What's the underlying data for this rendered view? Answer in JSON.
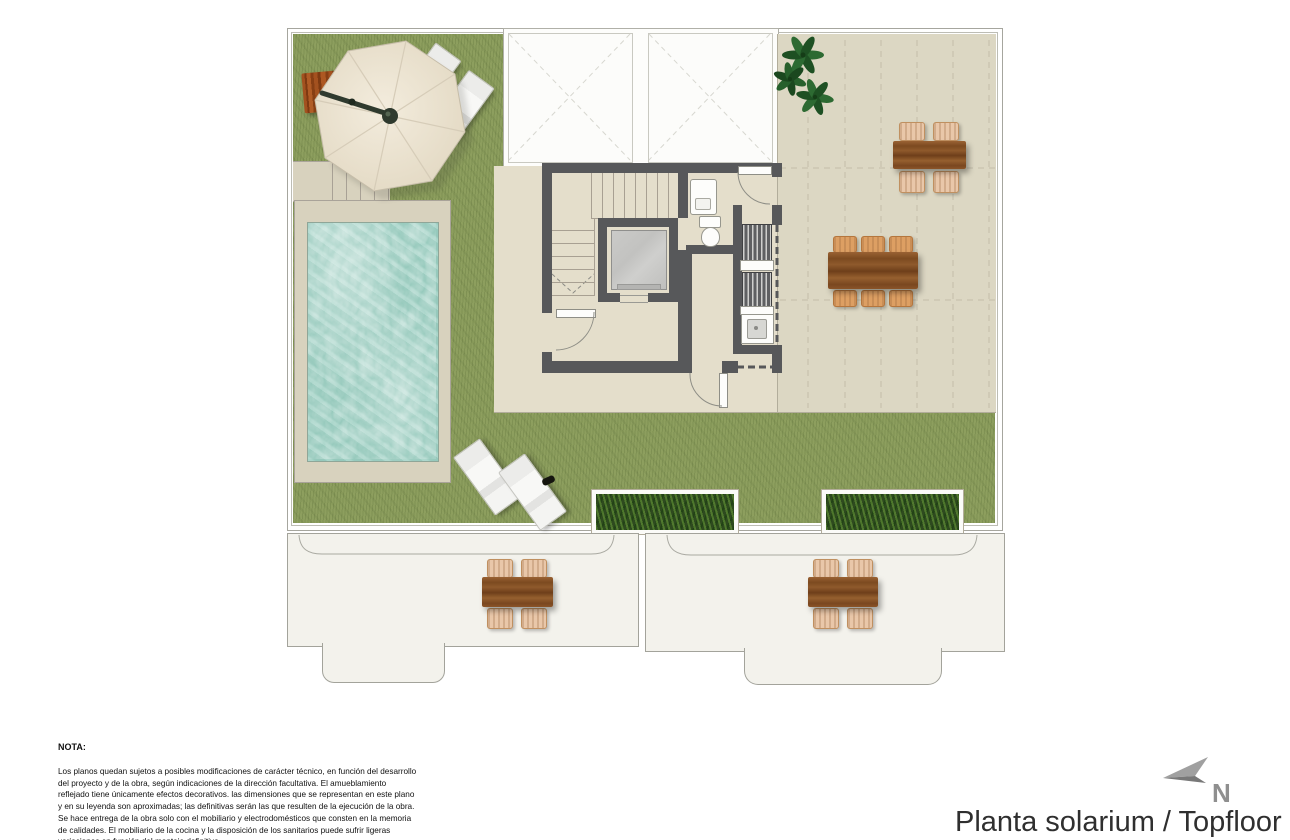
{
  "title": "Planta solarium / Topfloor",
  "compass": {
    "label": "N"
  },
  "note": {
    "heading": "NOTA:",
    "body": "Los planos quedan sujetos a posibles modificaciones de carácter técnico, en función del desarrollo del proyecto y de la obra, según indicaciones de la dirección facultativa. El amueblamiento reflejado tiene únicamente efectos decorativos. las dimensiones que se representan en este plano y en su leyenda son aproximadas; las definitivas serán las que resulten de la ejecución de la obra. Se hace entrega de la obra solo con el mobiliario y electrodomésticos que consten en la memoria de calidades. El mobiliario de la cocina y la disposición de los sanitarios puede sufrir ligeras variaciones en función del montaje definitivo."
  },
  "plan": {
    "floor_name": "Planta solarium / Topfloor",
    "features": [
      "pool",
      "garden lawn",
      "solarium terrace",
      "parasol",
      "sun loungers",
      "outdoor dining tables",
      "planters",
      "stairs",
      "elevator",
      "toilet",
      "utility room",
      "skylight voids"
    ],
    "colors": {
      "grass": "#8fa060",
      "water": "#9ccfc2",
      "terrace": "#dcd7c3",
      "paved": "#e4decb",
      "deck": "#d8d2be",
      "wall": "#57585a",
      "wood": "#8a5a2e",
      "lower_terrace": "#f3f2ec"
    }
  }
}
